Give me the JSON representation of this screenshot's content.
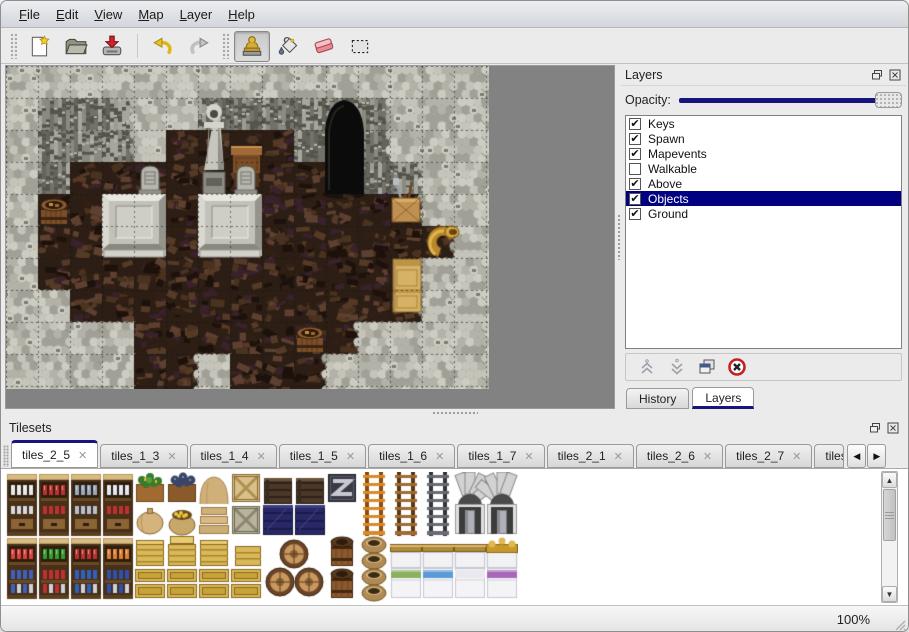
{
  "menu": {
    "items": [
      {
        "label": "File"
      },
      {
        "label": "Edit"
      },
      {
        "label": "View"
      },
      {
        "label": "Map"
      },
      {
        "label": "Layer"
      },
      {
        "label": "Help"
      }
    ]
  },
  "toolbar": {
    "buttons": [
      {
        "icon": "new-file-icon"
      },
      {
        "icon": "open-folder-icon"
      },
      {
        "icon": "save-icon"
      },
      {
        "icon": "undo-icon"
      },
      {
        "icon": "redo-icon"
      },
      {
        "icon": "stamp-tool-icon",
        "active": true
      },
      {
        "icon": "fill-tool-icon"
      },
      {
        "icon": "eraser-tool-icon"
      },
      {
        "icon": "select-tool-icon"
      }
    ]
  },
  "layers_panel": {
    "title": "Layers",
    "opacity_label": "Opacity:",
    "opacity_value_fraction": 1.0,
    "items": [
      {
        "label": "Keys",
        "checked": true
      },
      {
        "label": "Spawn",
        "checked": true
      },
      {
        "label": "Mapevents",
        "checked": true
      },
      {
        "label": "Walkable",
        "checked": false
      },
      {
        "label": "Above",
        "checked": true
      },
      {
        "label": "Objects",
        "checked": true,
        "selected": true
      },
      {
        "label": "Ground",
        "checked": true
      }
    ],
    "tabs": [
      {
        "label": "History",
        "active": false
      },
      {
        "label": "Layers",
        "active": true
      }
    ],
    "colors": {
      "selection": "#000080",
      "slider_track": "#15157d"
    }
  },
  "tilesets_panel": {
    "title": "Tilesets",
    "tabs": [
      {
        "label": "tiles_2_5",
        "active": true
      },
      {
        "label": "tiles_1_3"
      },
      {
        "label": "tiles_1_4"
      },
      {
        "label": "tiles_1_5"
      },
      {
        "label": "tiles_1_6"
      },
      {
        "label": "tiles_1_7"
      },
      {
        "label": "tiles_2_1"
      },
      {
        "label": "tiles_2_6"
      },
      {
        "label": "tiles_2_7"
      },
      {
        "label": "tiles_",
        "truncated": true
      }
    ]
  },
  "statusbar": {
    "zoom": "100%"
  },
  "map": {
    "tile_size": 32,
    "legend": {
      "S": "scale-rock",
      "C": "cliff-wall",
      "F": "dark-wood-floor"
    },
    "grid": [
      "SSSSSSSSSSSSSSS",
      "SCCCSSCCCCCCSSS",
      "SCCCSFFFFCCCSSS",
      "SCFFFFFFFFCCCSS",
      "SFFFFFFFFFFFFSS",
      "SFFFFFFFFFFFFFS",
      "SFFFFFFFFFFFFSS",
      "SSFFFFFFFFFFFSS",
      "SSSSFFFFFFFSSSS",
      "SSSSFFSFFFSSSSS"
    ],
    "objects": [
      {
        "name": "cave-entrance",
        "col": 10,
        "row": 1
      },
      {
        "name": "statue",
        "col": 6,
        "row": 1
      },
      {
        "name": "desk",
        "col": 7,
        "row": 2
      },
      {
        "name": "gravestone",
        "col": 4,
        "row": 3
      },
      {
        "name": "gravestone",
        "col": 7,
        "row": 3
      },
      {
        "name": "platform",
        "col": 3,
        "row": 4
      },
      {
        "name": "platform",
        "col": 6,
        "row": 4
      },
      {
        "name": "barrel",
        "col": 1,
        "row": 4
      },
      {
        "name": "crate-tools",
        "col": 12,
        "row": 4
      },
      {
        "name": "horn",
        "col": 13,
        "row": 5
      },
      {
        "name": "cabinet",
        "col": 12,
        "row": 6
      },
      {
        "name": "barrel",
        "col": 9,
        "row": 8
      }
    ],
    "colors": {
      "scale_rock": "#b4b4aa",
      "cliff": "#8e8e84",
      "floor": "#2c1e15",
      "viewport_bg": "#828282"
    }
  },
  "tileset": {
    "rows": [
      [
        "shelfA:#e8e8e8",
        "shelfA:#c03030",
        "shelfA:#9aa8c0",
        "shelfA:#e0e8f0",
        "plantcrate",
        "coalcrate",
        "sacktop",
        "cratex",
        "darkwood",
        "darkwood",
        "metalcrate",
        "ladtop:o",
        "ladtop:b",
        "ladtop:g",
        "archL",
        "archR"
      ],
      [
        "shelfAb:#d8d8e0",
        "shelfAb:#c03030",
        "shelfAb:#b8c0d0",
        "shelfAb:#c03030",
        "sackround",
        "sackgold",
        "sackflat",
        "cratexg",
        "darkcrate",
        "darkcrate",
        "empty",
        "ladbot:o",
        "ladbot:b",
        "ladbot:g",
        "doorL",
        "doorR"
      ],
      [
        "shelfB:#e04040",
        "shelfB:#30a030",
        "shelfB:#c03030",
        "shelfB:#e08030",
        "crateP",
        "crateL",
        "crateP",
        "crateP2",
        "barrels4",
        "none",
        "barrelU",
        "pots",
        "bedhead:plain",
        "bedhead:plain",
        "bedhead:plain",
        "bedhead:gold"
      ],
      [
        "shelfBb:#4060c0",
        "shelfBb:#c03030",
        "shelfBb:#3060c0",
        "shelfBb:#3050b0",
        "crateS",
        "crateS",
        "crateS",
        "crateS",
        "none",
        "none",
        "barrelU",
        "pots",
        "bedfoot:#8cb062",
        "bedfoot:#5a9ad8",
        "bedfoot:#ffffff",
        "bedfoot:#a868b8"
      ]
    ]
  }
}
